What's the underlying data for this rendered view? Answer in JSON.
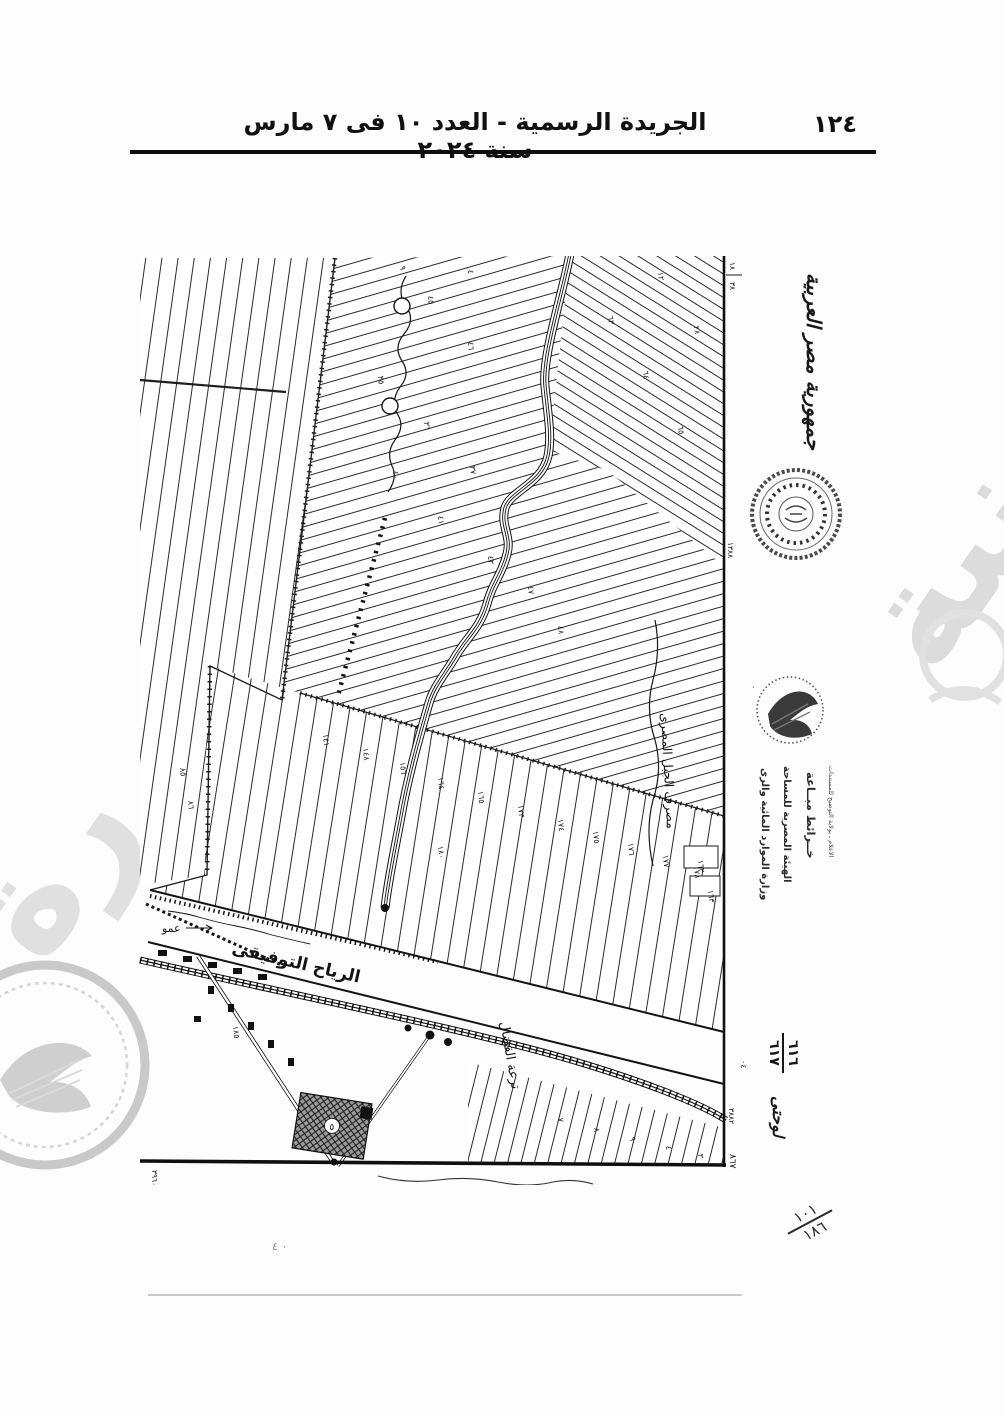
{
  "header": {
    "title": "الجريدة الرسمية - العدد ١٠ فى ٧ مارس سنة ٢٠٢٤",
    "page_number": "١٢٤"
  },
  "side": {
    "country": "جمهورية مصر العربية",
    "stamp": {
      "line1": "وزارة الموارد المائية والرى",
      "line2": "الهيئة المصرية للمساحة",
      "line3": "خــرائط مبــاعة",
      "line4": "الاعلام ـ بولاية التوضيح للمستندات"
    },
    "sheet": {
      "word": "لوحتى",
      "num_top": "٦١٦",
      "num_bottom": "٦١٧",
      "side_note": "٠٤"
    },
    "page_fraction": {
      "top": "١٠١",
      "bottom": "١٨٦"
    },
    "dots_note": "٠  ٤"
  },
  "map": {
    "canal_label": "الرياح التوفيقى",
    "drain_label": "مصرف الجبل المصرى",
    "canal2_label": "ترعة القضال",
    "road_note": "عمو",
    "building_number": "٥",
    "frame_numbers": {
      "top_a": "١٨",
      "top_b": "٣٨",
      "mid": "١٣٨٨",
      "low": "٣٨٨٢",
      "bottom": "٨٦٧",
      "left_bottom": "٣٩٦٠"
    },
    "parcel_numbers": [
      {
        "t": "٤٥",
        "x": 290,
        "y": 40
      },
      {
        "t": "٤٦",
        "x": 330,
        "y": 86
      },
      {
        "t": "٣٥",
        "x": 240,
        "y": 120
      },
      {
        "t": "٣٦",
        "x": 286,
        "y": 166
      },
      {
        "t": "٣٧",
        "x": 332,
        "y": 210
      },
      {
        "t": "٤٠",
        "x": 255,
        "y": 215
      },
      {
        "t": "٤١",
        "x": 300,
        "y": 260
      },
      {
        "t": "٤٢",
        "x": 350,
        "y": 300
      },
      {
        "t": "٤٧",
        "x": 390,
        "y": 330
      },
      {
        "t": "٤٨",
        "x": 420,
        "y": 370
      },
      {
        "t": "٨٥",
        "x": 42,
        "y": 512
      },
      {
        "t": "٨٦",
        "x": 50,
        "y": 545
      },
      {
        "t": "٦٣",
        "x": 470,
        "y": 60
      },
      {
        "t": "٦٤",
        "x": 505,
        "y": 115
      },
      {
        "t": "٦٥",
        "x": 540,
        "y": 170
      },
      {
        "t": "٢٨",
        "x": 556,
        "y": 70
      },
      {
        "t": "١٤١",
        "x": 185,
        "y": 478
      },
      {
        "t": "١٤٨",
        "x": 225,
        "y": 492
      },
      {
        "t": "١٥٦",
        "x": 262,
        "y": 506
      },
      {
        "t": "١٦٤",
        "x": 300,
        "y": 521
      },
      {
        "t": "١٦٥",
        "x": 340,
        "y": 535
      },
      {
        "t": "١٧٣",
        "x": 380,
        "y": 549
      },
      {
        "t": "١٧٤",
        "x": 420,
        "y": 563
      },
      {
        "t": "١٧٥",
        "x": 455,
        "y": 575
      },
      {
        "t": "١٧٦",
        "x": 490,
        "y": 587
      },
      {
        "t": "١٧٧",
        "x": 525,
        "y": 599
      },
      {
        "t": "١٧٨",
        "x": 556,
        "y": 610
      },
      {
        "t": "١٨٠",
        "x": 300,
        "y": 590
      },
      {
        "t": "١٦٢",
        "x": 560,
        "y": 604
      },
      {
        "t": "١٦٣",
        "x": 570,
        "y": 634
      },
      {
        "t": "٧",
        "x": 420,
        "y": 862
      },
      {
        "t": "٨",
        "x": 456,
        "y": 872
      },
      {
        "t": "٩",
        "x": 492,
        "y": 881
      },
      {
        "t": "٤",
        "x": 528,
        "y": 890
      },
      {
        "t": "٣",
        "x": 560,
        "y": 898
      },
      {
        "t": "١٨٥",
        "x": 95,
        "y": 770
      },
      {
        "t": "٤",
        "x": 330,
        "y": 14
      },
      {
        "t": "٩",
        "x": 262,
        "y": 10
      },
      {
        "t": "١٢",
        "x": 520,
        "y": 16
      }
    ]
  }
}
